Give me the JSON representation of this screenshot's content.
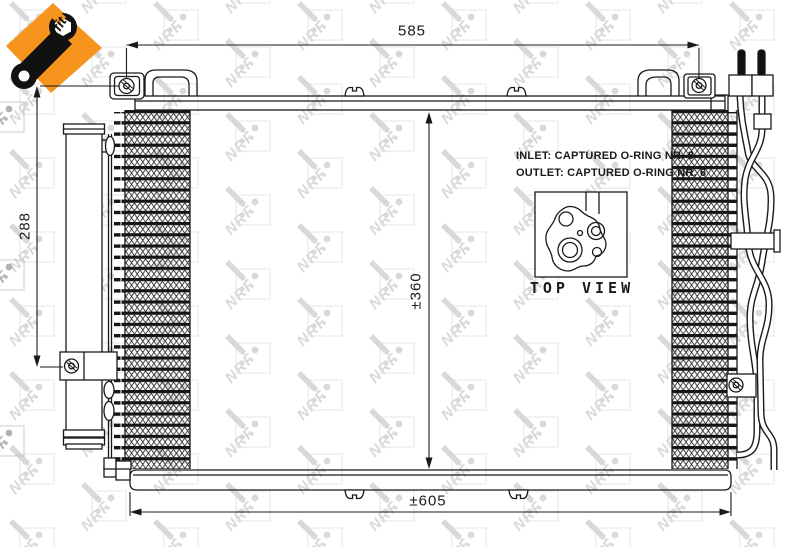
{
  "watermark": {
    "brand": "NRF"
  },
  "logo": {
    "label": "easyfit",
    "orange": "#f7941e"
  },
  "dimensions": {
    "top_width": "585",
    "left_height": "288",
    "core_height": "±360",
    "bottom_width": "±605"
  },
  "notes": {
    "inlet": "INLET: CAPTURED O-RING NR. 8",
    "outlet": "OUTLET: CAPTURED O-RING NR. 6",
    "top_view": "TOP VIEW"
  },
  "colors": {
    "line": "#1a1a1a",
    "watermark_gray": "#d6d6d6",
    "watermark_dark": "#b3b3b3",
    "accent_orange": "#f7941e"
  }
}
